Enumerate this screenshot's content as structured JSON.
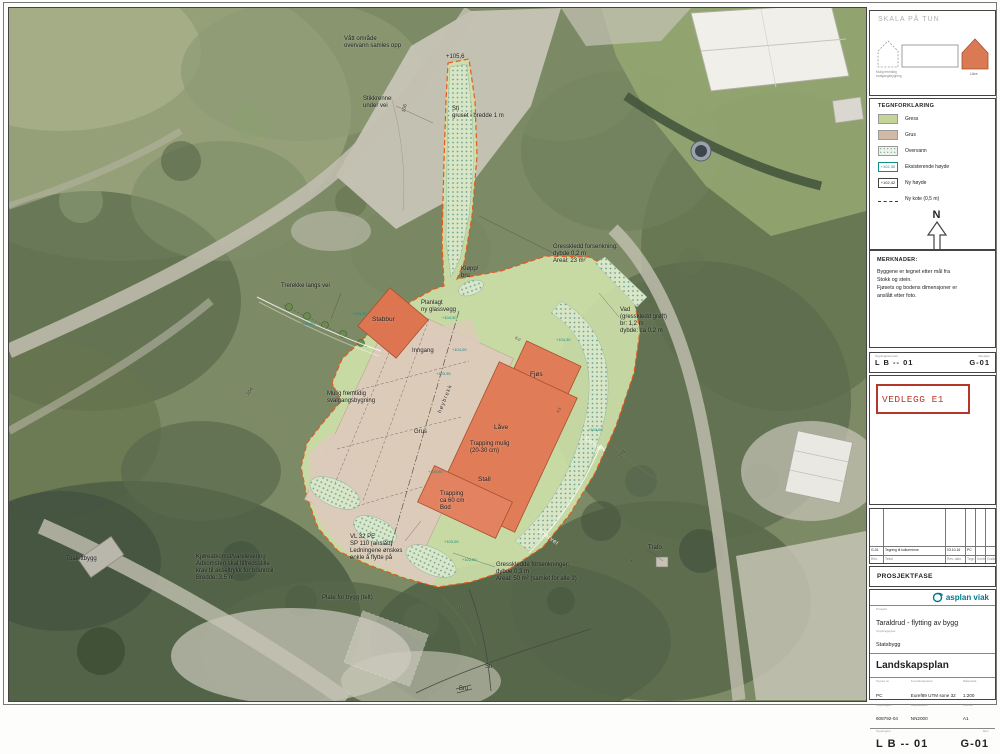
{
  "side": {
    "skala": {
      "title": "SKALA PÅ TUN",
      "caption1": "Mulig fremtidig",
      "caption2": "svalgangsbygning",
      "lave": "Låve"
    },
    "legend": {
      "title": "TEGNFORKLARING",
      "items": [
        {
          "label": "Gress",
          "sw": "grass"
        },
        {
          "label": "Grus",
          "sw": "grus"
        },
        {
          "label": "Overvann",
          "sw": "overvann"
        },
        {
          "label": "Eksisterende høyde",
          "sw": "eks",
          "text": "+102,30"
        },
        {
          "label": "Ny høyde",
          "sw": "ny",
          "text": "+102,42"
        },
        {
          "label": "Ny kote (0,5 m)",
          "sw": "kote"
        }
      ]
    },
    "north_label": "N",
    "merknader": {
      "title": "MERKNADER:",
      "body": "Byggene er tegnet etter mål fra\nStokk og stein.\nFjøsets og bodens dimensjoner er\nanslått etter foto."
    },
    "strip": {
      "left_label": "Tegningsnummer",
      "left": "L B -- 01",
      "right_label": "Revisjon",
      "right": "G-01"
    },
    "vedlegg": "VEDLEGG E1",
    "revision": {
      "row": {
        "rev": "G-01",
        "text": "Tegning til kulturminne",
        "date": "03.10.16",
        "sign": "PC",
        "ctrl": "",
        "appr": ""
      },
      "labels": {
        "rev": "Rev.",
        "text": "Tekst",
        "date": "Rev. dato",
        "sign": "Tegn",
        "ctrl": "Kontr",
        "appr": "Godkj"
      }
    },
    "prosjektfase": "PROSJEKTFASE",
    "title_block": {
      "logo": "asplan viak",
      "project_label": "Prosjekt",
      "project": "Taraldrud - flytting av bygg",
      "client_label": "Oppdragsgiver",
      "client": "Statsbygg",
      "drawing_title": "Landskapsplan",
      "fields": [
        {
          "label": "Tegnet av",
          "value": "PC"
        },
        {
          "label": "Koordinatsystem",
          "value": "Euref89 UTM sone 32"
        },
        {
          "label": "Målestokk",
          "value": "1:200"
        },
        {
          "label": "Oppdragsnr.",
          "value": "608792-04"
        },
        {
          "label": "Høydedatum",
          "value": "NN2000"
        },
        {
          "label": "Format",
          "value": "A1"
        }
      ],
      "code_label": "Tegningsnr.",
      "code": "L B -- 01",
      "rev_label": "Rev.",
      "rev": "G-01"
    }
  },
  "plan": {
    "colors": {
      "grass": "#cfe2ab",
      "grus": "#decbbb",
      "building": "#e07c57",
      "boundary_dash": "#e8571a",
      "overvann_dot": "#6fa092",
      "spot_height": "#0f8f84"
    },
    "labels": [
      {
        "t": "Vått område\novervann samles opp",
        "x": 344,
        "y": 36
      },
      {
        "t": "+105,6",
        "x": 446,
        "y": 54
      },
      {
        "t": "Stikkrenne\nunder vei",
        "x": 363,
        "y": 96
      },
      {
        "t": "Sti\ngruset i bredde 1 m",
        "x": 452,
        "y": 106
      },
      {
        "t": "Gresskledd forsenkning:\ndybde 0,2 m\nAreal: 23 m²",
        "x": 553,
        "y": 244
      },
      {
        "t": "Trerekke langs vei",
        "x": 281,
        "y": 283
      },
      {
        "t": "Kløpp/\nbru",
        "x": 461,
        "y": 266
      },
      {
        "t": "Planlagt\nny glassvegg",
        "x": 421,
        "y": 300
      },
      {
        "t": "Stabbur",
        "x": 372,
        "y": 316,
        "cls": "big"
      },
      {
        "t": "Inngang",
        "x": 412,
        "y": 348
      },
      {
        "t": "Vad\n(gresskledd grøft)\nbr: 1,2 m\ndybde: ca 0,2 m",
        "x": 620,
        "y": 307
      },
      {
        "t": "Fjøs",
        "x": 530,
        "y": 371,
        "cls": "big"
      },
      {
        "t": "Mulig fremtidig\nsvalgangsbygning",
        "x": 327,
        "y": 391
      },
      {
        "t": "Grus",
        "x": 414,
        "y": 429
      },
      {
        "t": "høybrekk",
        "x": 437,
        "y": 412,
        "rot": -68,
        "cls": "axis"
      },
      {
        "t": "Låve",
        "x": 494,
        "y": 424,
        "cls": "big"
      },
      {
        "t": "Trapping mulig\n(20-30 cm)",
        "x": 470,
        "y": 441
      },
      {
        "t": "Stall",
        "x": 478,
        "y": 476,
        "cls": "big"
      },
      {
        "t": "Trapping\nca 60 cm\nBod",
        "x": 440,
        "y": 491
      },
      {
        "t": "Gresskledde forsenkninger:\ndybde 0,3 m\nAreal: 50 m² (samlet for alle 3)",
        "x": 496,
        "y": 562
      },
      {
        "t": "VL 32 PE\nSP 110 (anslått)\nLedningene ønskes\nenkle å flytte på",
        "x": 350,
        "y": 534
      },
      {
        "t": "Kjøreatkomst/varelevering\nAdkomsten skal tilfredsstille\nkrav til akseltrykk for brannbil\nBredde: 3,5 m",
        "x": 196,
        "y": 554
      },
      {
        "t": "Plate for bygg (telt)",
        "x": 322,
        "y": 595
      },
      {
        "t": "Toalettbygg",
        "x": 66,
        "y": 556
      },
      {
        "t": "Trafo",
        "x": 648,
        "y": 545
      },
      {
        "t": "Sti",
        "x": 485,
        "y": 664
      },
      {
        "t": "Bru",
        "x": 459,
        "y": 686
      },
      {
        "t": "106",
        "x": 402,
        "y": 112,
        "rot": -78,
        "cls": "contour"
      },
      {
        "t": "104",
        "x": 246,
        "y": 394,
        "rot": -55,
        "cls": "contour"
      },
      {
        "t": "103",
        "x": 618,
        "y": 456,
        "rot": -50,
        "cls": "contour"
      },
      {
        "t": "102",
        "x": 458,
        "y": 607,
        "rot": -15,
        "cls": "contour"
      },
      {
        "t": "×",
        "x": 630,
        "y": 560,
        "cls": "contour"
      },
      {
        "t": "Snarvei",
        "x": 586,
        "y": 436,
        "rot": 32,
        "cls": "white"
      },
      {
        "t": "Snarvei",
        "x": 540,
        "y": 528,
        "rot": 36,
        "cls": "white"
      },
      {
        "t": "+104,39",
        "x": 352,
        "y": 312,
        "cls": "spot"
      },
      {
        "t": "+104,26",
        "x": 300,
        "y": 322,
        "cls": "spot"
      },
      {
        "t": "+104,50",
        "x": 442,
        "y": 316,
        "cls": "spot"
      },
      {
        "t": "+104,00",
        "x": 452,
        "y": 348,
        "cls": "spot"
      },
      {
        "t": "+103,95",
        "x": 436,
        "y": 372,
        "cls": "spot"
      },
      {
        "t": "+103,50",
        "x": 428,
        "y": 470,
        "cls": "spot"
      },
      {
        "t": "+103,00",
        "x": 444,
        "y": 540,
        "cls": "spot"
      },
      {
        "t": "+104,30",
        "x": 556,
        "y": 338,
        "cls": "spot"
      },
      {
        "t": "+103,60",
        "x": 588,
        "y": 428,
        "cls": "spot"
      },
      {
        "t": "+102,80",
        "x": 462,
        "y": 558,
        "cls": "spot"
      },
      {
        "t": "8,0",
        "x": 516,
        "y": 336,
        "rot": 25,
        "cls": "dim"
      },
      {
        "t": "4,5",
        "x": 556,
        "y": 412,
        "rot": -65,
        "cls": "dim"
      }
    ]
  }
}
